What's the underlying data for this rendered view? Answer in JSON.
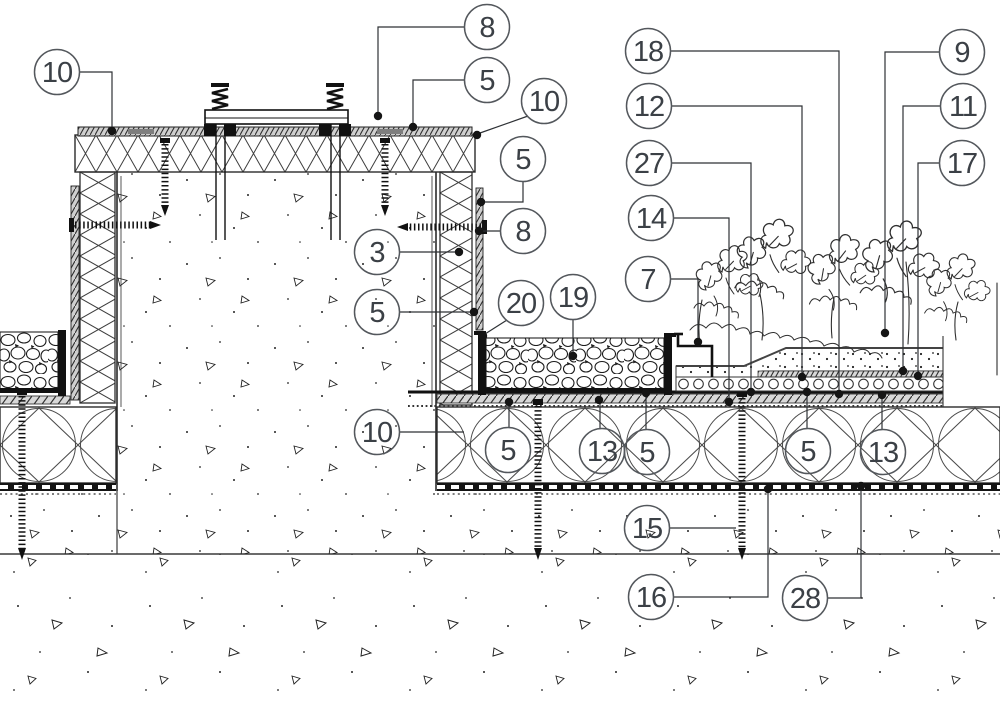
{
  "canvas": {
    "width": 1000,
    "height": 708,
    "background": "#ffffff",
    "line_color": "#2e3135",
    "callout_stroke": "#53575c",
    "callout_text_color": "#3b4046",
    "dot_color": "#151515"
  },
  "drawing": {
    "kind": "construction-detail-section",
    "features": [
      "insulated-curb",
      "green-roof-buildup",
      "gravel-strips",
      "concrete-structure",
      "vegetation"
    ]
  },
  "callouts": [
    {
      "label": "10",
      "cx": 57,
      "cy": 72,
      "leader": "M79,72 H112 V128",
      "dot": [
        112,
        131
      ]
    },
    {
      "label": "8",
      "cx": 487,
      "cy": 27,
      "leader": "M465,27 H378 V112",
      "dot": [
        378,
        116
      ]
    },
    {
      "label": "5",
      "cx": 487,
      "cy": 80,
      "leader": "M465,80 H413 V123",
      "dot": [
        413,
        127
      ]
    },
    {
      "label": "10",
      "cx": 544,
      "cy": 101,
      "leader": "M528,116 L480,133",
      "dot": [
        477,
        135
      ]
    },
    {
      "label": "5",
      "cx": 523,
      "cy": 159,
      "leader": "M523,181 V202 H484",
      "dot": [
        481,
        202
      ]
    },
    {
      "label": "8",
      "cx": 523,
      "cy": 231,
      "leader": "M501,231 H482",
      "dot": [
        479,
        231
      ]
    },
    {
      "label": "3",
      "cx": 377,
      "cy": 252,
      "leader": "M399,252 H456",
      "dot": [
        459,
        252
      ]
    },
    {
      "label": "5",
      "cx": 377,
      "cy": 312,
      "leader": "M399,312 H471",
      "dot": [
        474,
        312
      ]
    },
    {
      "label": "20",
      "cx": 521,
      "cy": 303,
      "leader": "M507,320 L485,334",
      "dot": [
        483,
        336
      ]
    },
    {
      "label": "19",
      "cx": 573,
      "cy": 297,
      "leader": "M573,319 V353",
      "dot": [
        573,
        356
      ]
    },
    {
      "label": "7",
      "cx": 648,
      "cy": 279,
      "leader": "M670,279 H698 V339",
      "dot": [
        698,
        342
      ]
    },
    {
      "label": "14",
      "cx": 651,
      "cy": 218,
      "leader": "M673,218 H729 V399",
      "dot": [
        729,
        402
      ]
    },
    {
      "label": "27",
      "cx": 649,
      "cy": 163,
      "leader": "M671,163 H751 V389",
      "dot": [
        751,
        392
      ]
    },
    {
      "label": "12",
      "cx": 649,
      "cy": 106,
      "leader": "M671,106 H802 V374",
      "dot": [
        802,
        377
      ]
    },
    {
      "label": "18",
      "cx": 648,
      "cy": 51,
      "leader": "M670,51 H839 V390",
      "dot": [
        839,
        394
      ]
    },
    {
      "label": "9",
      "cx": 962,
      "cy": 52,
      "leader": "M940,52 H885 V329",
      "dot": [
        885,
        333
      ]
    },
    {
      "label": "11",
      "cx": 963,
      "cy": 106,
      "leader": "M941,106 H903 V367",
      "dot": [
        903,
        371
      ]
    },
    {
      "label": "17",
      "cx": 962,
      "cy": 163,
      "leader": "M940,163 H918 V372",
      "dot": [
        918,
        376
      ]
    },
    {
      "label": "10",
      "cx": 377,
      "cy": 432,
      "leader": "M399,432 H464",
      "dot": null
    },
    {
      "label": "5",
      "cx": 508,
      "cy": 450,
      "leader": "M509,428 V405",
      "dot": [
        509,
        402
      ]
    },
    {
      "label": "13",
      "cx": 602,
      "cy": 451,
      "leader": "M600,429 V403",
      "dot": [
        599,
        400
      ]
    },
    {
      "label": "5",
      "cx": 647,
      "cy": 452,
      "leader": "M646,430 V397",
      "dot": [
        646,
        393
      ]
    },
    {
      "label": "5",
      "cx": 808,
      "cy": 451,
      "leader": "M807,429 V396",
      "dot": [
        807,
        392
      ]
    },
    {
      "label": "13",
      "cx": 883,
      "cy": 452,
      "leader": "M882,430 V399",
      "dot": [
        882,
        395
      ]
    },
    {
      "label": "15",
      "cx": 647,
      "cy": 528,
      "leader": "M669,528 H736",
      "dot": null
    },
    {
      "label": "16",
      "cx": 651,
      "cy": 597,
      "leader": "M673,597 H768 V492",
      "dot": [
        768,
        489
      ]
    },
    {
      "label": "28",
      "cx": 805,
      "cy": 598,
      "leader": "M827,598 H861 V490",
      "dot": [
        861,
        486
      ]
    }
  ]
}
